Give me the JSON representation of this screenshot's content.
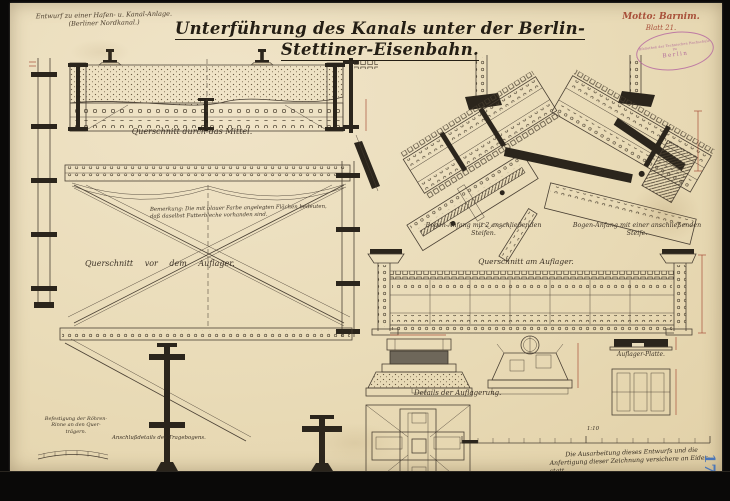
{
  "header": {
    "project_line1": "Entwurf zu einer Hafen- u. Kanal-Anlage.",
    "project_line2": "(Berliner Nordkanal.)",
    "title": "Unterführung des Kanals unter der Berlin-Stettiner-Eisenbahn.",
    "motto": "Motto: Barnim.",
    "sheet": "Blatt 21.",
    "stamp_rim_top": "Bibliothek der Technischen Hochschule",
    "stamp_mid": "zu",
    "stamp_center": "Berlin"
  },
  "captions": {
    "cross_section_mid": "Querschnitt durch das Mittel.",
    "remark_line1": "Bemerkung: Die mit blauer Farbe angelegten Flächen bedeuten,",
    "remark_line2": "daß daselbst Futterbleche vorhanden sind.",
    "cross_section_before_support": "Querschnitt vor dem Auflager.",
    "arch_start_two_1": "Bogen-Anfang mit 2 anschließenden",
    "arch_start_two_2": "Steifen.",
    "arch_start_one_1": "Bogen-Anfang mit einer anschließenden",
    "arch_start_one_2": "Steife.",
    "cross_section_at_support": "Querschnitt am Auflager.",
    "pipe_fixing_1": "Befestigung der Röhren-",
    "pipe_fixing_2": "Rinne an den Quer-",
    "pipe_fixing_3": "trägern.",
    "arch_connection": "Anschlußdetails des Tragebogens.",
    "bearing_details": "Details der Auflagerung.",
    "bearing_plate": "Auflager-Platte.",
    "scale": "1:10"
  },
  "footer": {
    "attest_line1": "Die Ausarbeitung dieses Entwurfs und die",
    "attest_line2": "Anfertigung dieser Zeichnung versichere an Eides-",
    "attest_line3": "statt.",
    "place_date": "Berlin, d. 13/X. 1886.",
    "signature": "F. Gerlach,",
    "signature_title": "Regierungs-Bauführer.",
    "archive_number": "17"
  },
  "colors": {
    "paper": "#e9dbb7",
    "ink": "#42382a",
    "dark_ink": "#2b251c",
    "red_accent": "#a8503a",
    "stamp_purple": "#b464a0",
    "blue_number": "#4a76b8",
    "scan_background": "#0a0908"
  }
}
